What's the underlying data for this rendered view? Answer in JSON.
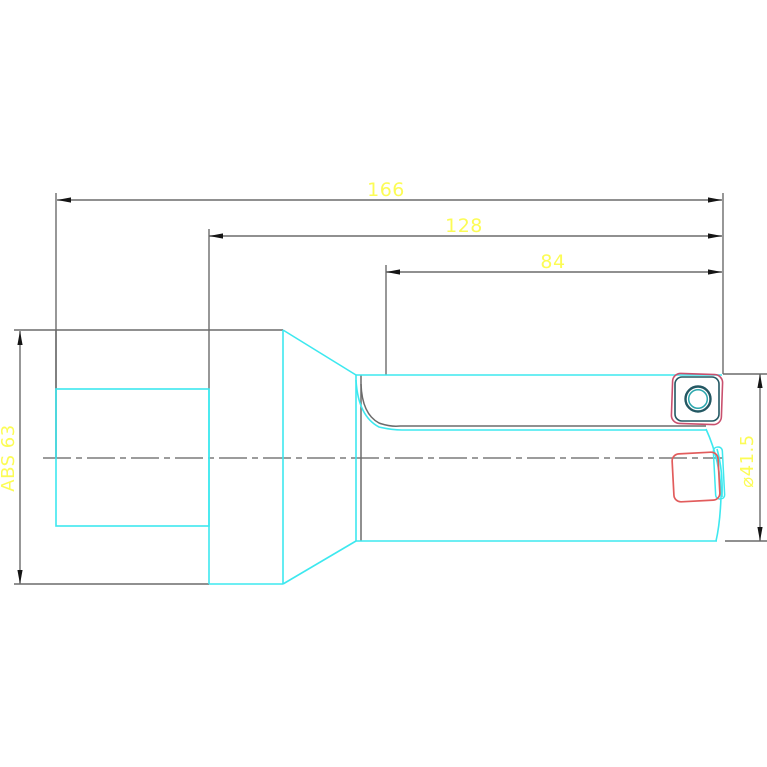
{
  "drawing": {
    "dimensions": {
      "overall_length": "166",
      "body_length": "128",
      "flute_length": "84",
      "shank_label": "ABS 63",
      "diameter_label": "⌀41.5"
    },
    "colors": {
      "background": "#ffffff",
      "outline_cyan": "#3de8ef",
      "dimension_gray": "#6b6b6b",
      "centerline_gray": "#606060",
      "arrow_black": "#151515",
      "label_yellow": "#fcfc55",
      "insert_red_front": "#e25c5c",
      "insert_red_top": "#c9506e",
      "insert_teal_dark": "#235863",
      "hole_teal": "#2aa7ad"
    }
  }
}
